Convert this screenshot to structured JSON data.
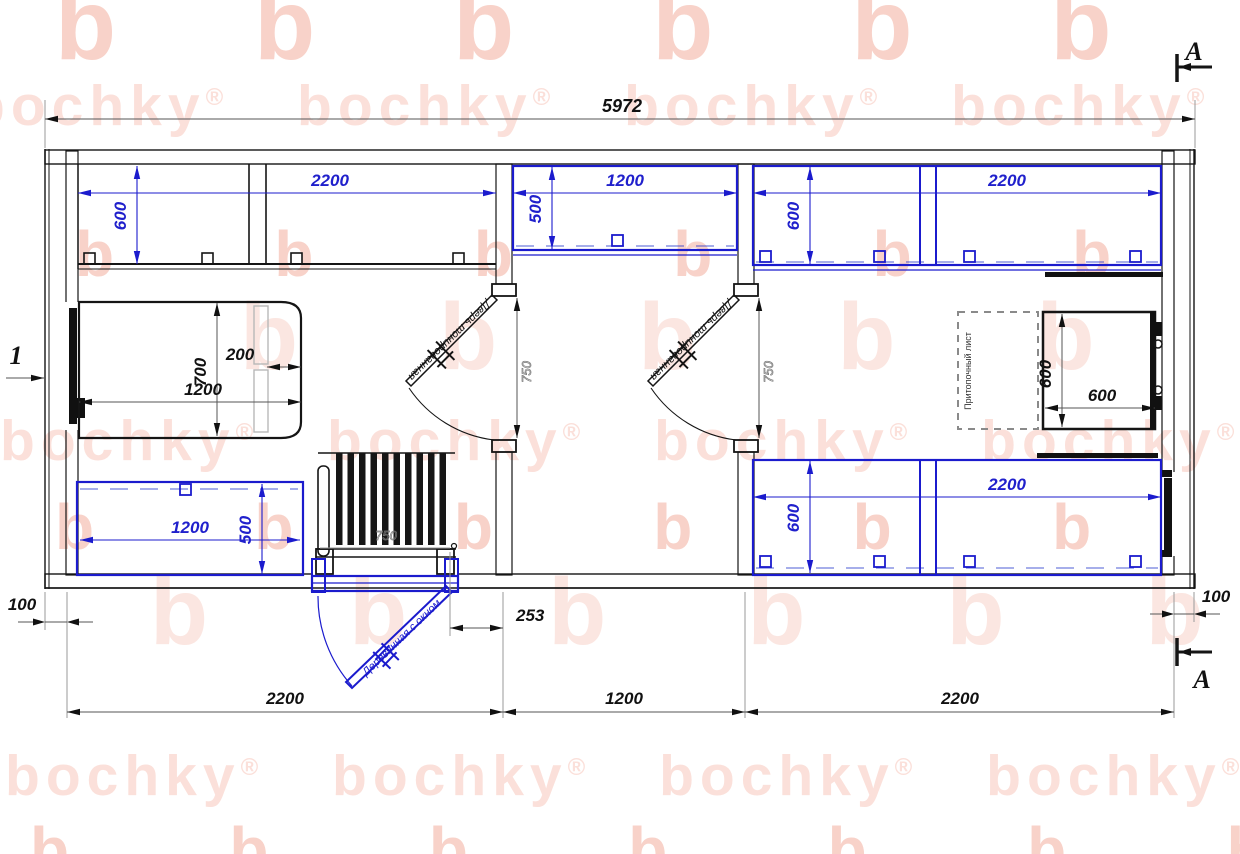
{
  "watermark": {
    "word": "bochky",
    "registered": "®",
    "letter": "b",
    "word_color": "#fbe0da",
    "letter_color": "#f8d2c9"
  },
  "colors": {
    "dimension_blue": "#2020cc",
    "line_black": "#151515"
  },
  "marks": {
    "section_a_top": "A",
    "section_a_bottom": "A",
    "view_1": "1"
  },
  "dims": {
    "total": "5972",
    "left_bench_w": "2200",
    "left_bench_d": "600",
    "bed_l": "1200",
    "bed_w": "700",
    "bed_head": "200",
    "left_low_w": "1200",
    "left_low_d": "500",
    "mid_bench_w": "1200",
    "mid_bench_d": "500",
    "right_top_w": "2200",
    "right_top_d": "600",
    "right_low_w": "2200",
    "right_low_d": "600",
    "stove_w": "600",
    "stove_h": "600",
    "door1_w": "750",
    "door2_w": "750",
    "door3_w": "750",
    "offset_253": "253",
    "wall_l": "100",
    "wall_r": "100",
    "bottom_left": "2200",
    "bottom_mid": "1200",
    "bottom_right": "2200"
  },
  "labels": {
    "door_int1": "Дверь тонированная",
    "door_int2": "Дверь тонированная",
    "door_ent": "Деревянная с окном",
    "stove_sheet": "Притопочный лист"
  }
}
